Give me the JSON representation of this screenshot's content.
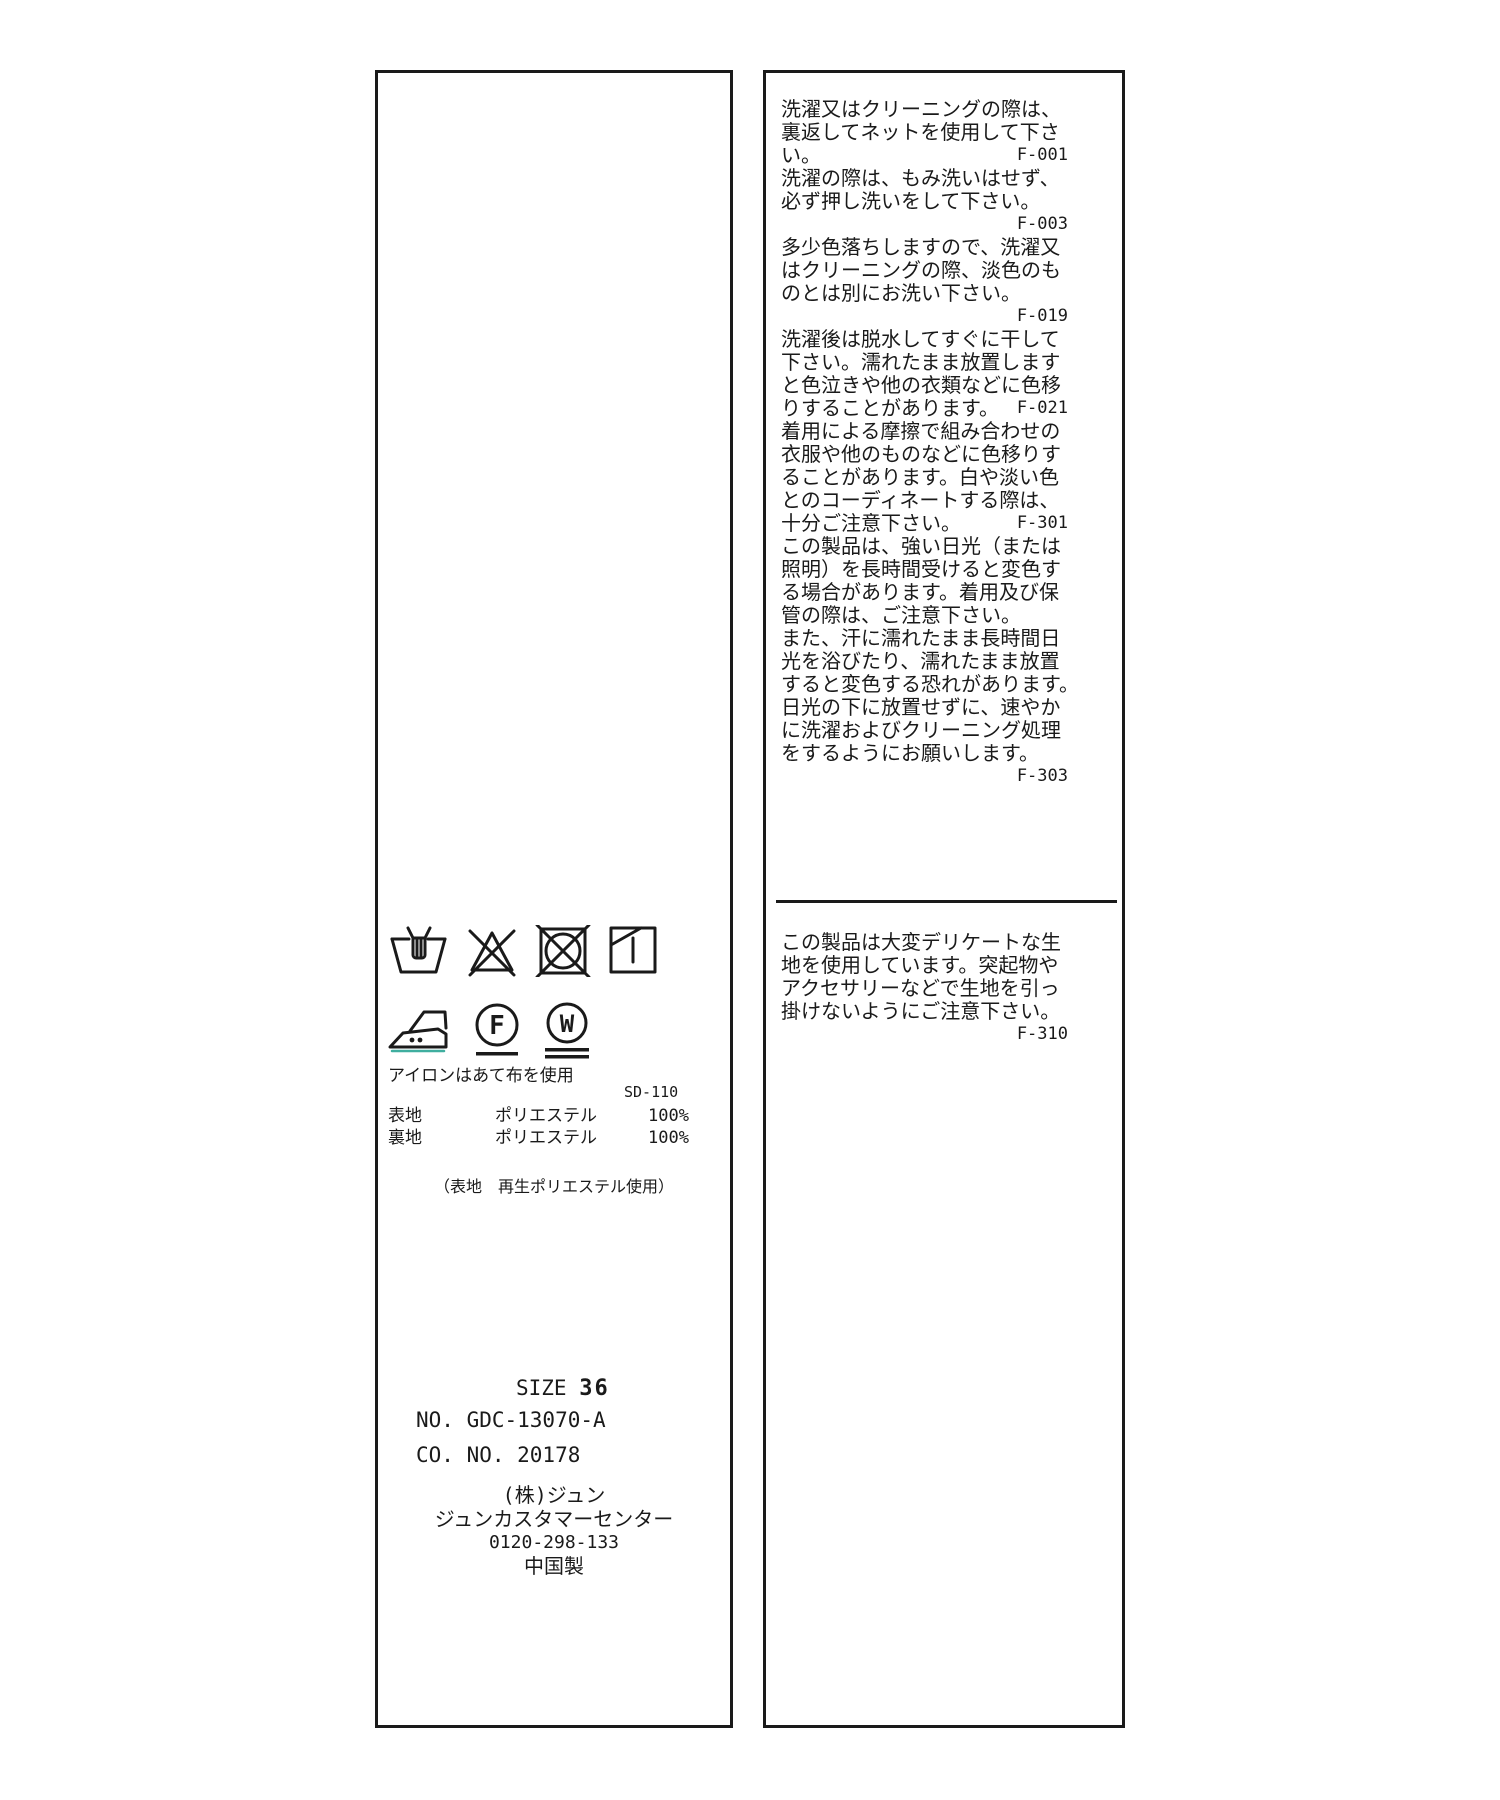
{
  "colors": {
    "ink": "#1a1a1a",
    "bg": "#ffffff",
    "iron_accent": "#3fae9f"
  },
  "left_panel": {
    "care_symbols": {
      "row1": [
        "hand-wash",
        "do-not-bleach",
        "do-not-tumble-dry",
        "line-dry-in-shade"
      ],
      "row2": [
        "iron-two-dots",
        "dry-clean-F-gentle",
        "wet-clean-W-very-gentle"
      ]
    },
    "iron_letter_f": "F",
    "iron_letter_w": "W",
    "iron_note": "アイロンはあて布を使用",
    "doc_code": "SD-110",
    "composition": {
      "rows": [
        {
          "part": "表地",
          "material": "ポリエステル",
          "pct": "100%"
        },
        {
          "part": "裏地",
          "material": "ポリエステル",
          "pct": "100%"
        }
      ],
      "note": "（表地　再生ポリエステル使用）"
    },
    "size_label": "SIZE",
    "size_value": "36",
    "no_line": "NO. GDC-13070-A",
    "co_line": "CO. NO.  20178",
    "company": "(株)ジュン",
    "customer_center": "ジュンカスタマーセンター",
    "phone": "0120-298-133",
    "origin": "中国製"
  },
  "right_panel": {
    "sections": [
      {
        "lines": [
          {
            "t": "洗濯又はクリーニングの際は、",
            "c": ""
          },
          {
            "t": "裏返してネットを使用して下さ",
            "c": ""
          },
          {
            "t": "い。",
            "c": "F-001"
          },
          {
            "t": "洗濯の際は、もみ洗いはせず、",
            "c": ""
          },
          {
            "t": "必ず押し洗いをして下さい。",
            "c": ""
          },
          {
            "t": "",
            "c": "F-003"
          },
          {
            "t": "多少色落ちしますので、洗濯又",
            "c": ""
          },
          {
            "t": "はクリーニングの際、淡色のも",
            "c": ""
          },
          {
            "t": "のとは別にお洗い下さい。",
            "c": ""
          },
          {
            "t": "",
            "c": "F-019"
          },
          {
            "t": "洗濯後は脱水してすぐに干して",
            "c": ""
          },
          {
            "t": "下さい。濡れたまま放置します",
            "c": ""
          },
          {
            "t": "と色泣きや他の衣類などに色移",
            "c": ""
          },
          {
            "t": "りすることがあります。",
            "c": "F-021"
          },
          {
            "t": "着用による摩擦で組み合わせの",
            "c": ""
          },
          {
            "t": "衣服や他のものなどに色移りす",
            "c": ""
          },
          {
            "t": "ることがあります。白や淡い色",
            "c": ""
          },
          {
            "t": "とのコーディネートする際は、",
            "c": ""
          },
          {
            "t": "十分ご注意下さい。",
            "c": "F-301"
          },
          {
            "t": "この製品は、強い日光（または",
            "c": ""
          },
          {
            "t": "照明）を長時間受けると変色す",
            "c": ""
          },
          {
            "t": "る場合があります。着用及び保",
            "c": ""
          },
          {
            "t": "管の際は、ご注意下さい。",
            "c": ""
          },
          {
            "t": "また、汗に濡れたまま長時間日",
            "c": ""
          },
          {
            "t": "光を浴びたり、濡れたまま放置",
            "c": ""
          },
          {
            "t": "すると変色する恐れがあります。",
            "c": ""
          },
          {
            "t": "日光の下に放置せずに、速やか",
            "c": ""
          },
          {
            "t": "に洗濯およびクリーニング処理",
            "c": ""
          },
          {
            "t": "をするようにお願いします。",
            "c": ""
          },
          {
            "t": "",
            "c": "F-303"
          }
        ]
      },
      {
        "lines": [
          {
            "t": "この製品は大変デリケートな生",
            "c": ""
          },
          {
            "t": "地を使用しています。突起物や",
            "c": ""
          },
          {
            "t": "アクセサリーなどで生地を引っ",
            "c": ""
          },
          {
            "t": "掛けないようにご注意下さい。",
            "c": ""
          },
          {
            "t": "",
            "c": "F-310"
          }
        ]
      }
    ]
  }
}
